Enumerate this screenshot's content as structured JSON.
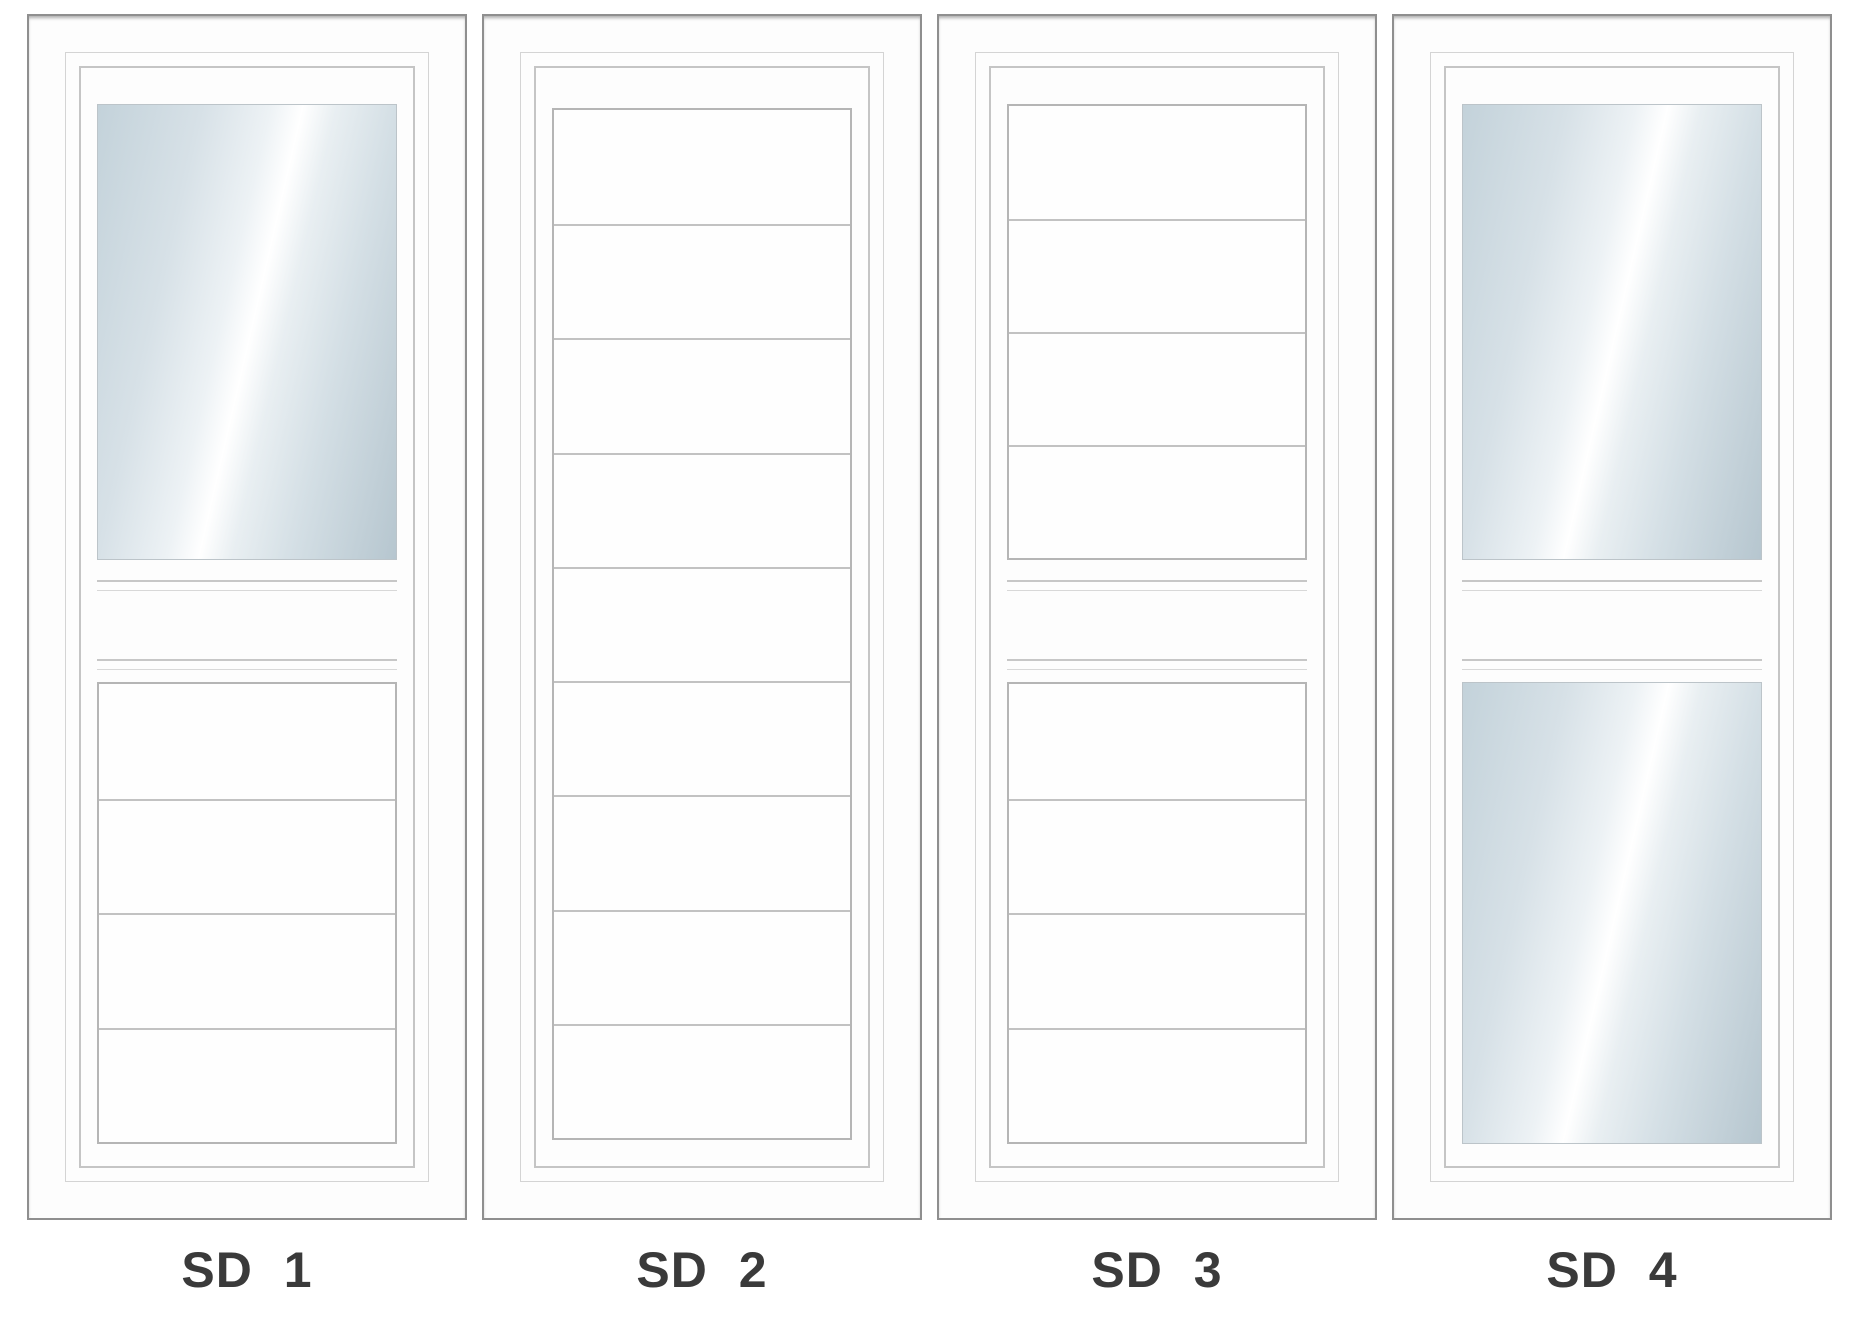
{
  "doors": [
    {
      "id": "sd1",
      "label": "SD 1",
      "blocks": [
        {
          "kind": "glass",
          "slot": "upper"
        },
        {
          "kind": "rails",
          "slot": "rail1"
        },
        {
          "kind": "rails",
          "slot": "rail2"
        },
        {
          "kind": "panel",
          "slot": "lower",
          "sections": 4
        }
      ]
    },
    {
      "id": "sd2",
      "label": "SD 2",
      "blocks": [
        {
          "kind": "panel",
          "slot": "full",
          "sections": 9
        }
      ]
    },
    {
      "id": "sd3",
      "label": "SD 3",
      "blocks": [
        {
          "kind": "panel",
          "slot": "upper",
          "sections": 4
        },
        {
          "kind": "rails",
          "slot": "rail1"
        },
        {
          "kind": "rails",
          "slot": "rail2"
        },
        {
          "kind": "panel",
          "slot": "lower",
          "sections": 4
        }
      ]
    },
    {
      "id": "sd4",
      "label": "SD 4",
      "blocks": [
        {
          "kind": "glass",
          "slot": "upper"
        },
        {
          "kind": "rails",
          "slot": "rail1"
        },
        {
          "kind": "rails",
          "slot": "rail2"
        },
        {
          "kind": "glass",
          "slot": "lower"
        }
      ]
    }
  ],
  "colors": {
    "page_bg": "#ffffff",
    "door_fill": "#fdfdfd",
    "door_border": "#8f8f8f",
    "frame_line_light": "#d4d4d4",
    "frame_line_mid": "#c5c5c5",
    "panel_border": "#b5b5b5",
    "panel_groove": "#c2c2c2",
    "rail_line_top": "#c7c7c7",
    "rail_line_bottom": "#d8d8d8",
    "glass_border": "#bcc4c9",
    "glass_tint_dark": "#b6c6cf",
    "glass_tint_light": "#edf2f5",
    "glass_highlight": "#ffffff",
    "label_text": "#3a3a3a"
  }
}
